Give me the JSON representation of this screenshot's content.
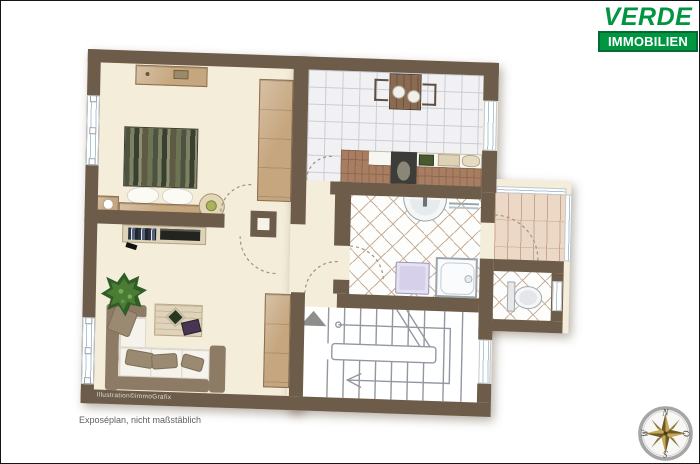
{
  "brand": {
    "name_top": "VERDE",
    "name_bottom": "IMMOBILIEN",
    "green": "#009540"
  },
  "footer": {
    "credit": "Illustration©immoGrafix",
    "disclaimer": "Exposéplan, nicht maßstäblich"
  },
  "compass": {
    "north": "N",
    "east": "O",
    "south": "S",
    "west": "W"
  },
  "plan": {
    "type": "apartment-floor-plan",
    "rooms": [
      "bedroom",
      "kitchen",
      "hallway",
      "bathroom",
      "balcony",
      "wc",
      "living-room",
      "staircase"
    ],
    "colors": {
      "wall": "#6d5c4a",
      "floor_beige": "#f4edda",
      "kitchen_tile": "#f1f1f4",
      "bath_tile_line": "#c6b09b",
      "balcony_plank": "#ecd8c6",
      "wood": "#c6a67e",
      "brand_green": "#009540"
    }
  }
}
